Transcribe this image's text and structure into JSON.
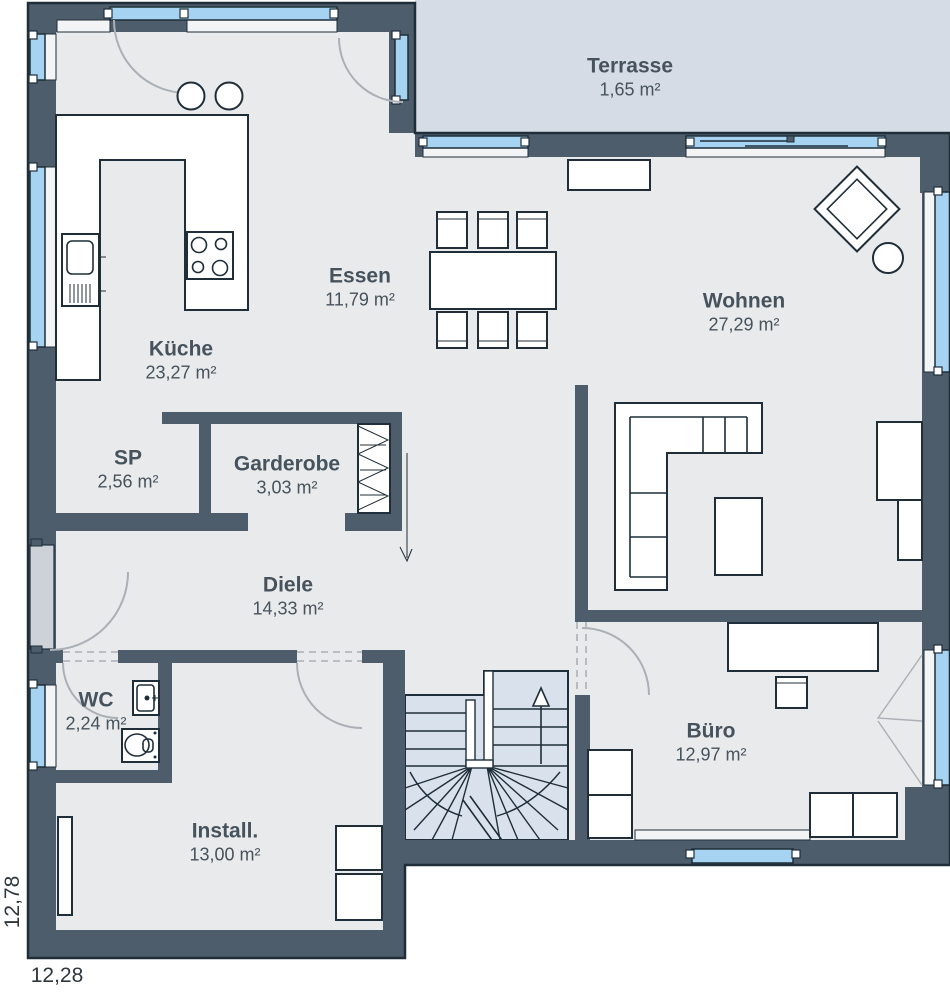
{
  "plan": {
    "rooms": [
      {
        "id": "terrasse",
        "name": "Terrasse",
        "area": "1,65 m²"
      },
      {
        "id": "kueche",
        "name": "Küche",
        "area": "23,27 m²"
      },
      {
        "id": "essen",
        "name": "Essen",
        "area": "11,79 m²"
      },
      {
        "id": "wohnen",
        "name": "Wohnen",
        "area": "27,29 m²"
      },
      {
        "id": "sp",
        "name": "SP",
        "area": "2,56 m²"
      },
      {
        "id": "garderobe",
        "name": "Garderobe",
        "area": "3,03 m²"
      },
      {
        "id": "diele",
        "name": "Diele",
        "area": "14,33 m²"
      },
      {
        "id": "wc",
        "name": "WC",
        "area": "2,24 m²"
      },
      {
        "id": "install",
        "name": "Install.",
        "area": "13,00 m²"
      },
      {
        "id": "buero",
        "name": "Büro",
        "area": "12,97 m²"
      }
    ],
    "dimensions": {
      "width_label": "12,28",
      "height_label": "12,78"
    },
    "colors": {
      "wall": "#4d5d6b",
      "outline": "#1f2e38",
      "floor": "#e9eaec",
      "terrace": "#d6dce5",
      "stairs": "#d9e2ec",
      "glass": "#a6d3f1",
      "arc": "#aab0b5",
      "door": "#ccd2d8",
      "text": "#46525c"
    }
  }
}
